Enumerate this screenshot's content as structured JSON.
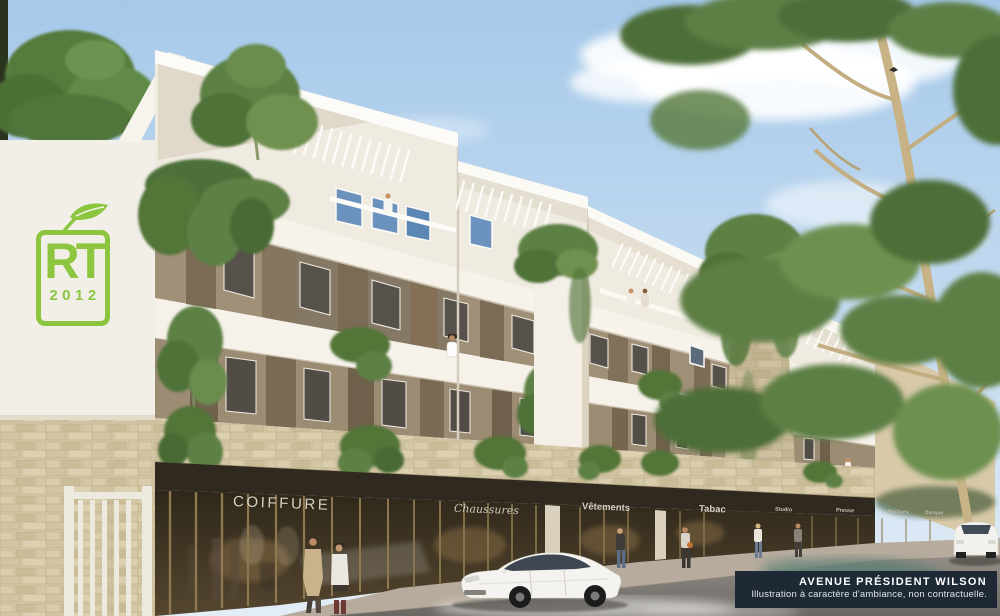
{
  "scene_description": "Architectural rendering of a modern white residential building with ground-floor shops on Avenue Président Wilson",
  "rt_logo": {
    "top": "RT",
    "bottom": "2012",
    "color": "#8cc63f"
  },
  "storefront_signs": [
    {
      "label": "COIFFURE"
    },
    {
      "label": "Chaussures"
    },
    {
      "label": "Vêtements"
    },
    {
      "label": "Tabac"
    },
    {
      "label": "Studio"
    },
    {
      "label": "Presse"
    },
    {
      "label": "Marques"
    },
    {
      "label": "Banque"
    }
  ],
  "caption": {
    "title": "AVENUE PRÉSIDENT WILSON",
    "subtitle": "Illustration à caractère d'ambiance, non contractuelle."
  },
  "colors": {
    "sky_top": "#a6c9ea",
    "sky_bottom": "#e2edf6",
    "facade": "#f0ebe1",
    "recess_taupe": "#a09078",
    "stone": "#d7cbab",
    "storefront_fascia": "#2f2920",
    "foliage": "#5d7f44",
    "caption_bg": "#1b2633",
    "logo_green": "#8cc63f"
  }
}
